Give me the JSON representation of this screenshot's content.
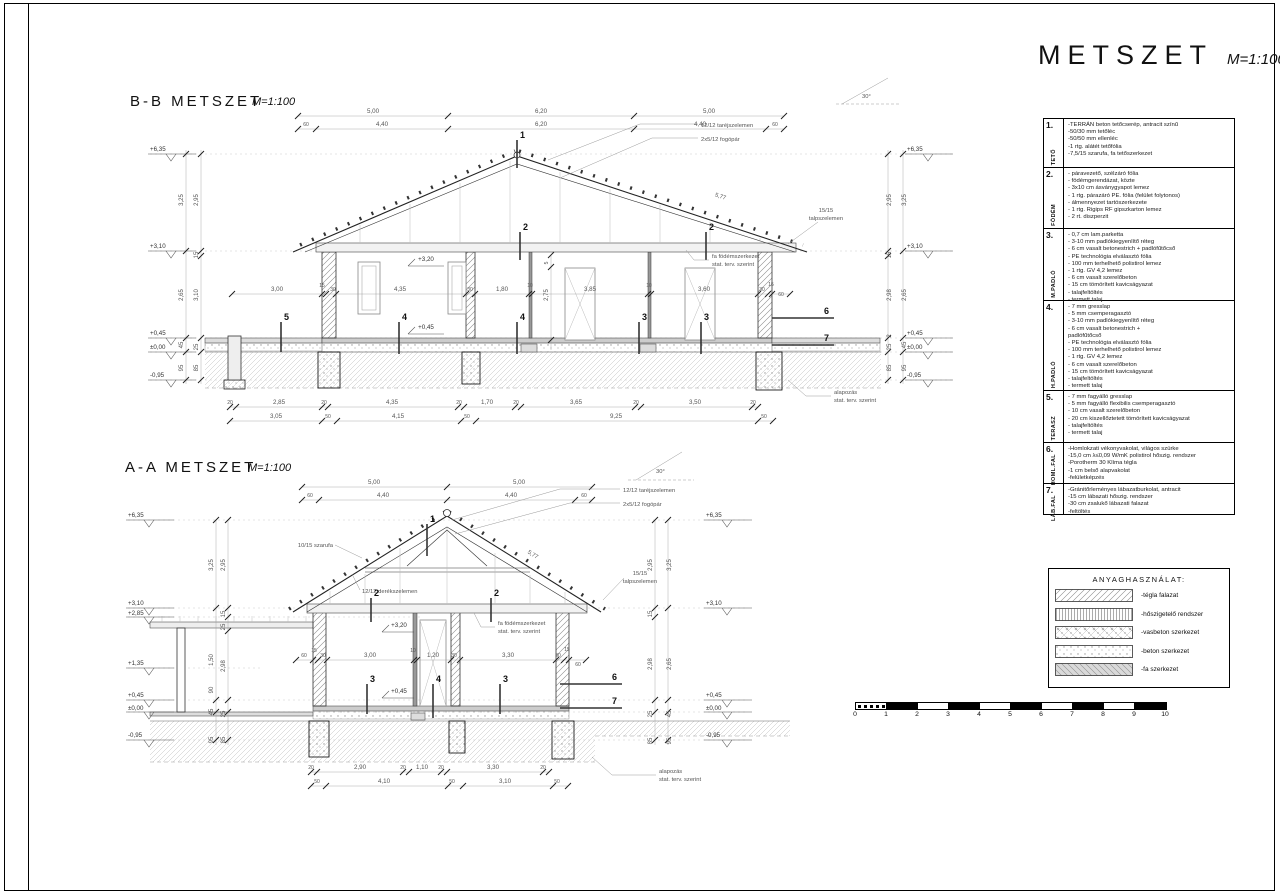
{
  "page": {
    "title": "METSZET",
    "scale": "M=1:100"
  },
  "sections": {
    "bb": {
      "label": "B-B METSZET",
      "scale": "M=1:100",
      "dims_top1": [
        "5,00",
        "6,20",
        "5,00"
      ],
      "dims_top2": [
        "60",
        "4,40",
        "6,20",
        "4,40",
        "60"
      ],
      "note_ridge": "12/12 taréjszelemen",
      "note_fogopar": "2x5/12 fogópár",
      "slope_length": "5,77",
      "note_talp1": "15/15",
      "note_talp2": "talpszelemen",
      "angle": "30°",
      "levels_left": [
        "+6,35",
        "+3,10",
        "+0,45",
        "±0,00",
        "-0,95"
      ],
      "levels_right": [
        "+6,35",
        "+3,10",
        "+0,45",
        "±0,00",
        "-0,95"
      ],
      "vchain_left_outer": [
        "3,25",
        "2,65",
        "45",
        "95"
      ],
      "vchain_left_inner": [
        "2,95",
        "15",
        "3,10",
        "25",
        "85"
      ],
      "vchain_right_outer": [
        "3,25",
        "2,65",
        "45",
        "95"
      ],
      "vchain_right_inner": [
        "2,95",
        "15",
        "2,98",
        "2",
        "25",
        "85"
      ],
      "level_320": "+3,20",
      "level_045": "+0,45",
      "vdim_small_top": "5",
      "vdim_door": "2,75",
      "dims_mid": [
        "3,00",
        "15",
        "30",
        "4,35",
        "30",
        "1,80",
        "10",
        "3,85",
        "10",
        "3,60",
        "30",
        "15",
        "60"
      ],
      "markers": {
        "m1": "1",
        "m2a": "2",
        "m2b": "2",
        "m5": "5",
        "m4a": "4",
        "m4b": "4",
        "m3a": "3",
        "m3b": "3",
        "m6": "6",
        "m7": "7"
      },
      "note_fodem1": "fa födémszerkezet",
      "note_fodem2": "stat. terv. szerint",
      "note_alap1": "alapozás",
      "note_alap2": "stat. terv. szerint",
      "dims_bot1": [
        "20",
        "2,85",
        "20",
        "4,35",
        "20",
        "1,70",
        "20",
        "3,65",
        "20",
        "3,50",
        "20"
      ],
      "dims_bot2": [
        "3,05",
        "50",
        "4,15",
        "50",
        "9,25",
        "50"
      ]
    },
    "aa": {
      "label": "A-A METSZET",
      "scale": "M=1:100",
      "dims_top1": [
        "5,00",
        "5,00"
      ],
      "dims_top2": [
        "60",
        "4,40",
        "4,40",
        "60"
      ],
      "note_ridge": "12/12 taréjszelemen",
      "note_fogopar": "2x5/12 fogópár",
      "note_szarufa": "10/15 szarufa",
      "note_derek": "12/12 derékszelemen",
      "slope_length": "5,77",
      "note_talp1": "15/15",
      "note_talp2": "talpszelemen",
      "angle": "30°",
      "levels_left": [
        "+6,35",
        "+3,10",
        "+2,85",
        "+1,35",
        "+0,45",
        "±0,00",
        "-0,95"
      ],
      "levels_right": [
        "+6,35",
        "+3,10",
        "+0,45",
        "±0,00",
        "-0,95"
      ],
      "vchain_left_outer": [
        "3,25",
        "1,50",
        "90",
        "45",
        "95"
      ],
      "vchain_left_inner": [
        "2,95",
        "15",
        "25",
        "2,98",
        "25",
        "85"
      ],
      "vchain_right_outer": [
        "3,25",
        "2,65",
        "45",
        "95"
      ],
      "vchain_right_inner": [
        "2,95",
        "15",
        "2,98",
        "25",
        "85"
      ],
      "level_320": "+3,20",
      "level_045": "+0,45",
      "dims_mid": [
        "60",
        "15",
        "30",
        "3,00",
        "10",
        "1,20",
        "30",
        "3,30",
        "30",
        "15",
        "60"
      ],
      "markers": {
        "m1": "1",
        "m2a": "2",
        "m2b": "2",
        "m3a": "3",
        "m4": "4",
        "m3b": "3",
        "m6": "6",
        "m7": "7"
      },
      "note_fodem1": "fa födémszerkezet",
      "note_fodem2": "stat. terv. szerint",
      "note_alap1": "alapozás",
      "note_alap2": "stat. terv. szerint",
      "dims_bot1": [
        "20",
        "2,90",
        "20",
        "1,10",
        "20",
        "3,30",
        "20"
      ],
      "dims_bot2": [
        "50",
        "4,10",
        "50",
        "3,10",
        "50"
      ]
    }
  },
  "notes_table": {
    "rows": [
      {
        "num": "1.",
        "label": "TETŐ",
        "lines": [
          "-TERRÁN beton tetőcserép, antracit színű",
          "-50/30 mm tetőléc",
          "-50/50 mm ellenléc",
          "-1 rtg. alátét tetőfólia",
          "-7,5/15 szarufa, fa tetőszerkezet"
        ]
      },
      {
        "num": "2.",
        "label": "FÖDÉM",
        "lines": [
          "- páravezető, szélzáró fólia",
          "- födémgerendázat, közte",
          "- 3x10 cm ásványgyapot lemez",
          "- 1 rtg. párazáró PE. fólia (felület folytonos)",
          "- álmennyezet tartószerkezete",
          "- 1 rtg. Rigips RF gipszkarton lemez",
          "- 2 rt. diszperzit"
        ]
      },
      {
        "num": "3.",
        "label": "M.PADLÓ",
        "lines": [
          "- 0,7 cm lam.parketta",
          "- 3-10 mm padlókiegyenlítő réteg",
          "- 6 cm vasalt betonestrich + padlófűtőcső",
          "- PE technológia elválasztó fólia",
          "- 100 mm terhelhető polistirol lemez",
          "- 1 rtg. GV 4,2 lemez",
          "- 6 cm vasalt szerelőbeton",
          "- 15 cm tömörített kavicságyazat",
          "- talajfeltöltés",
          "- termett talaj"
        ]
      },
      {
        "num": "4.",
        "label": "H.PADLÓ",
        "lines": [
          "- 7 mm gresslap",
          "- 5 mm csemperagasztó",
          "- 3-10 mm padlókiegyenlítő réteg",
          "- 6 cm vasalt betonestrich +",
          "  padlófűtőcső",
          "- PE technológia elválasztó fólia",
          "- 100 mm terhelhető polistirol lemez",
          "- 1 rtg. GV 4,2 lemez",
          "- 6 cm vasalt szerelőbeton",
          "- 15 cm tömörített kavicságyazat",
          "- talajfeltöltés",
          "- termett talaj"
        ]
      },
      {
        "num": "5.",
        "label": "TERASZ",
        "lines": [
          "- 7 mm fagyálló gresslap",
          "- 5 mm fagyálló flexibilis csemperagasztó",
          "- 10 cm vasalt szerelőbeton",
          "- 20 cm kiszellőztetett tömörített kavicságyazat",
          "- talajfeltöltés",
          "- termett talaj"
        ]
      },
      {
        "num": "6.",
        "label": "HOML.FAL",
        "lines": [
          "-Homlokzati vékonyvakolat, világos szürke",
          "-15,0 cm λ≤0,09 W/mK polistirol hőszig. rendszer",
          "-Porotherm 30 Klíma tégla",
          "-1 cm belső alapvakolat",
          "-felületképzés"
        ]
      },
      {
        "num": "7.",
        "label": "LÁB.FAL",
        "lines": [
          "-Gránitőrleményes lábazatburkolat, antracit",
          "-15 cm lábazati hőszig. rendszer",
          "-30 cm zsalukő lábazati falazat",
          "-feltöltés"
        ]
      }
    ]
  },
  "legend": {
    "title": "ANYAGHASZNÁLAT:",
    "items": [
      {
        "pattern": "brick-hatch",
        "label": "-tégla falazat"
      },
      {
        "pattern": "insulation-hatch",
        "label": "-hőszigetelő rendszer"
      },
      {
        "pattern": "reinforced-concrete-hatch",
        "label": "-vasbeton szerkezet"
      },
      {
        "pattern": "concrete-dots",
        "label": "-beton szerkezet"
      },
      {
        "pattern": "wood-hatch",
        "label": "-fa szerkezet"
      }
    ]
  },
  "scalebar": {
    "labels": [
      "0",
      "1",
      "2",
      "3",
      "4",
      "5",
      "6",
      "7",
      "8",
      "9",
      "10"
    ]
  }
}
